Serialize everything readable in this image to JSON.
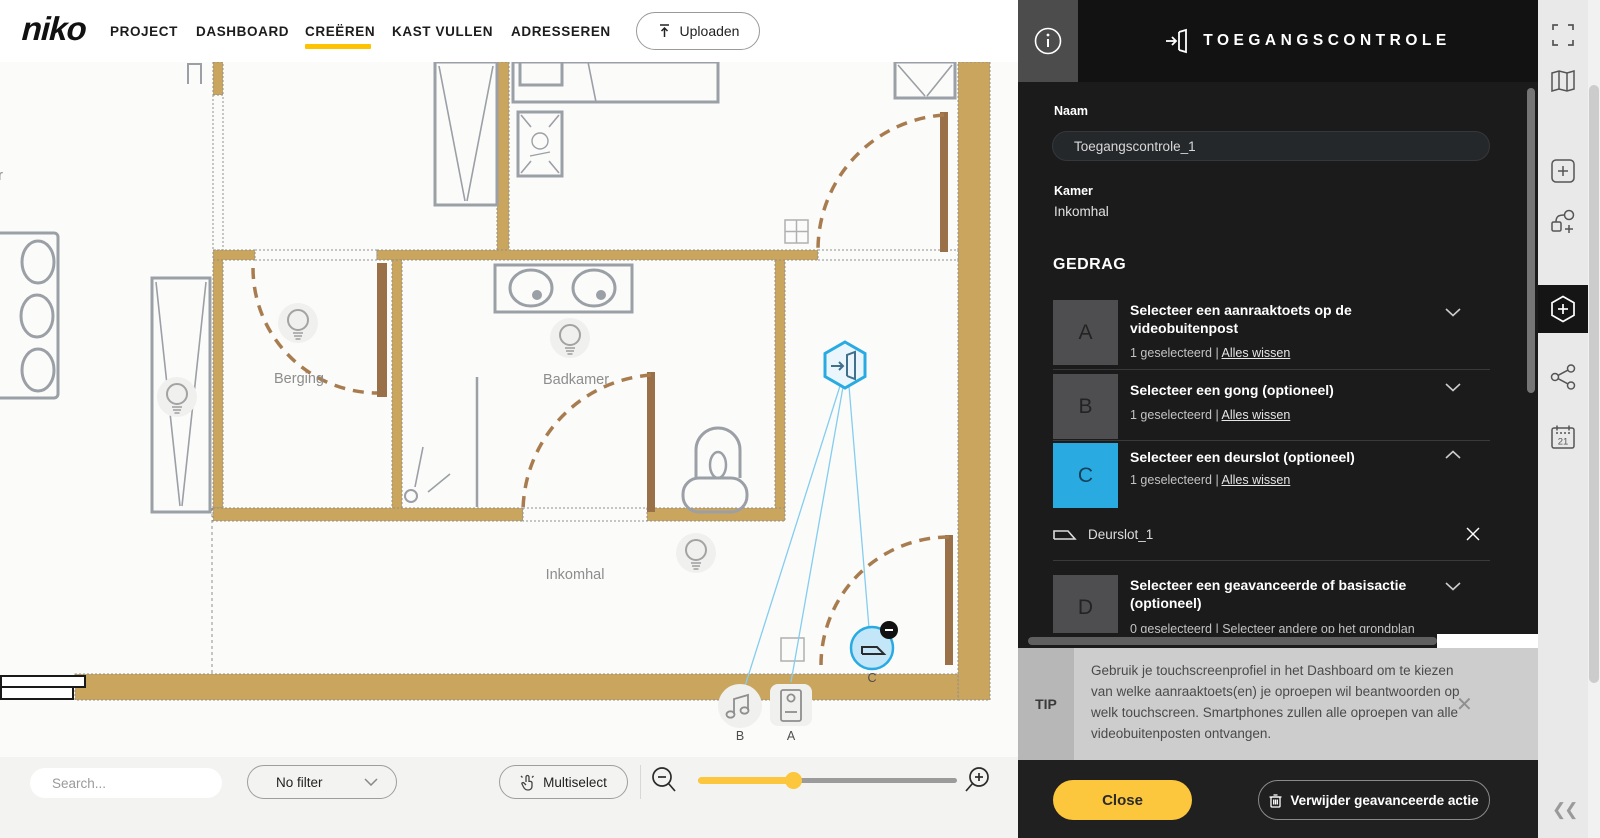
{
  "header": {
    "logo": "niko",
    "nav": [
      {
        "label": "PROJECT",
        "active": false
      },
      {
        "label": "DASHBOARD",
        "active": false
      },
      {
        "label": "CREËREN",
        "active": true
      },
      {
        "label": "KAST VULLEN",
        "active": false
      },
      {
        "label": "ADRESSEREN",
        "active": false
      }
    ],
    "upload_label": "Uploaden"
  },
  "panel": {
    "title": "TOEGANGSCONTROLE",
    "naam_label": "Naam",
    "naam_value": "Toegangscontrole_1",
    "kamer_label": "Kamer",
    "kamer_value": "Inkomhal",
    "gedrag_title": "GEDRAG",
    "items": [
      {
        "letter": "A",
        "title": "Selecteer een aanraaktoets op de videobuitenpost",
        "sub": "1 geselecteerd | ",
        "link": "Alles wissen"
      },
      {
        "letter": "B",
        "title": "Selecteer een gong (optioneel)",
        "sub": "1 geselecteerd | ",
        "link": "Alles wissen"
      },
      {
        "letter": "C",
        "title": "Selecteer een deurslot (optioneel)",
        "sub": "1 geselecteerd | ",
        "link": "Alles wissen",
        "child": "Deurslot_1"
      },
      {
        "letter": "D",
        "title": "Selecteer een geavanceerde of basisactie (optioneel)",
        "sub": "0 geselecteerd | Selecteer andere op het grondplan"
      }
    ],
    "tip": {
      "label": "TIP",
      "text": "Gebruik je touchscreenprofiel in het Dashboard om te kiezen van welke aanraaktoets(en) je oproepen wil beantwoorden op welk touchscreen. Smartphones zullen alle oproepen van alle videobuitenposten ontvangen."
    },
    "close_label": "Close",
    "delete_label": "Verwijder geavanceerde actie"
  },
  "toolbar": {
    "search_placeholder": "Search...",
    "filter_label": "No filter",
    "multiselect_label": "Multiselect"
  },
  "plan": {
    "rooms": {
      "berging": "Berging",
      "badkamer": "Badkamer",
      "inkomhal": "Inkomhal",
      "partial": "er"
    },
    "device_labels": {
      "a": "A",
      "b": "B",
      "c": "C"
    }
  },
  "icons": {
    "sidebar": [
      "fullscreen-icon",
      "map-icon",
      "add-square-icon",
      "add-connection-icon",
      "add-control-hexagon-icon",
      "network-icon",
      "calendar-21-icon",
      "collapse-icon"
    ],
    "calendar_day": "21"
  },
  "colors": {
    "accent_yellow": "#fcc63d",
    "nav_underline_yellow": "#fdc300",
    "accent_blue": "#29abe2",
    "wall_tan": "#c9a55e",
    "door_brown": "#9a7048",
    "panel_bg": "#1b1b1b"
  }
}
